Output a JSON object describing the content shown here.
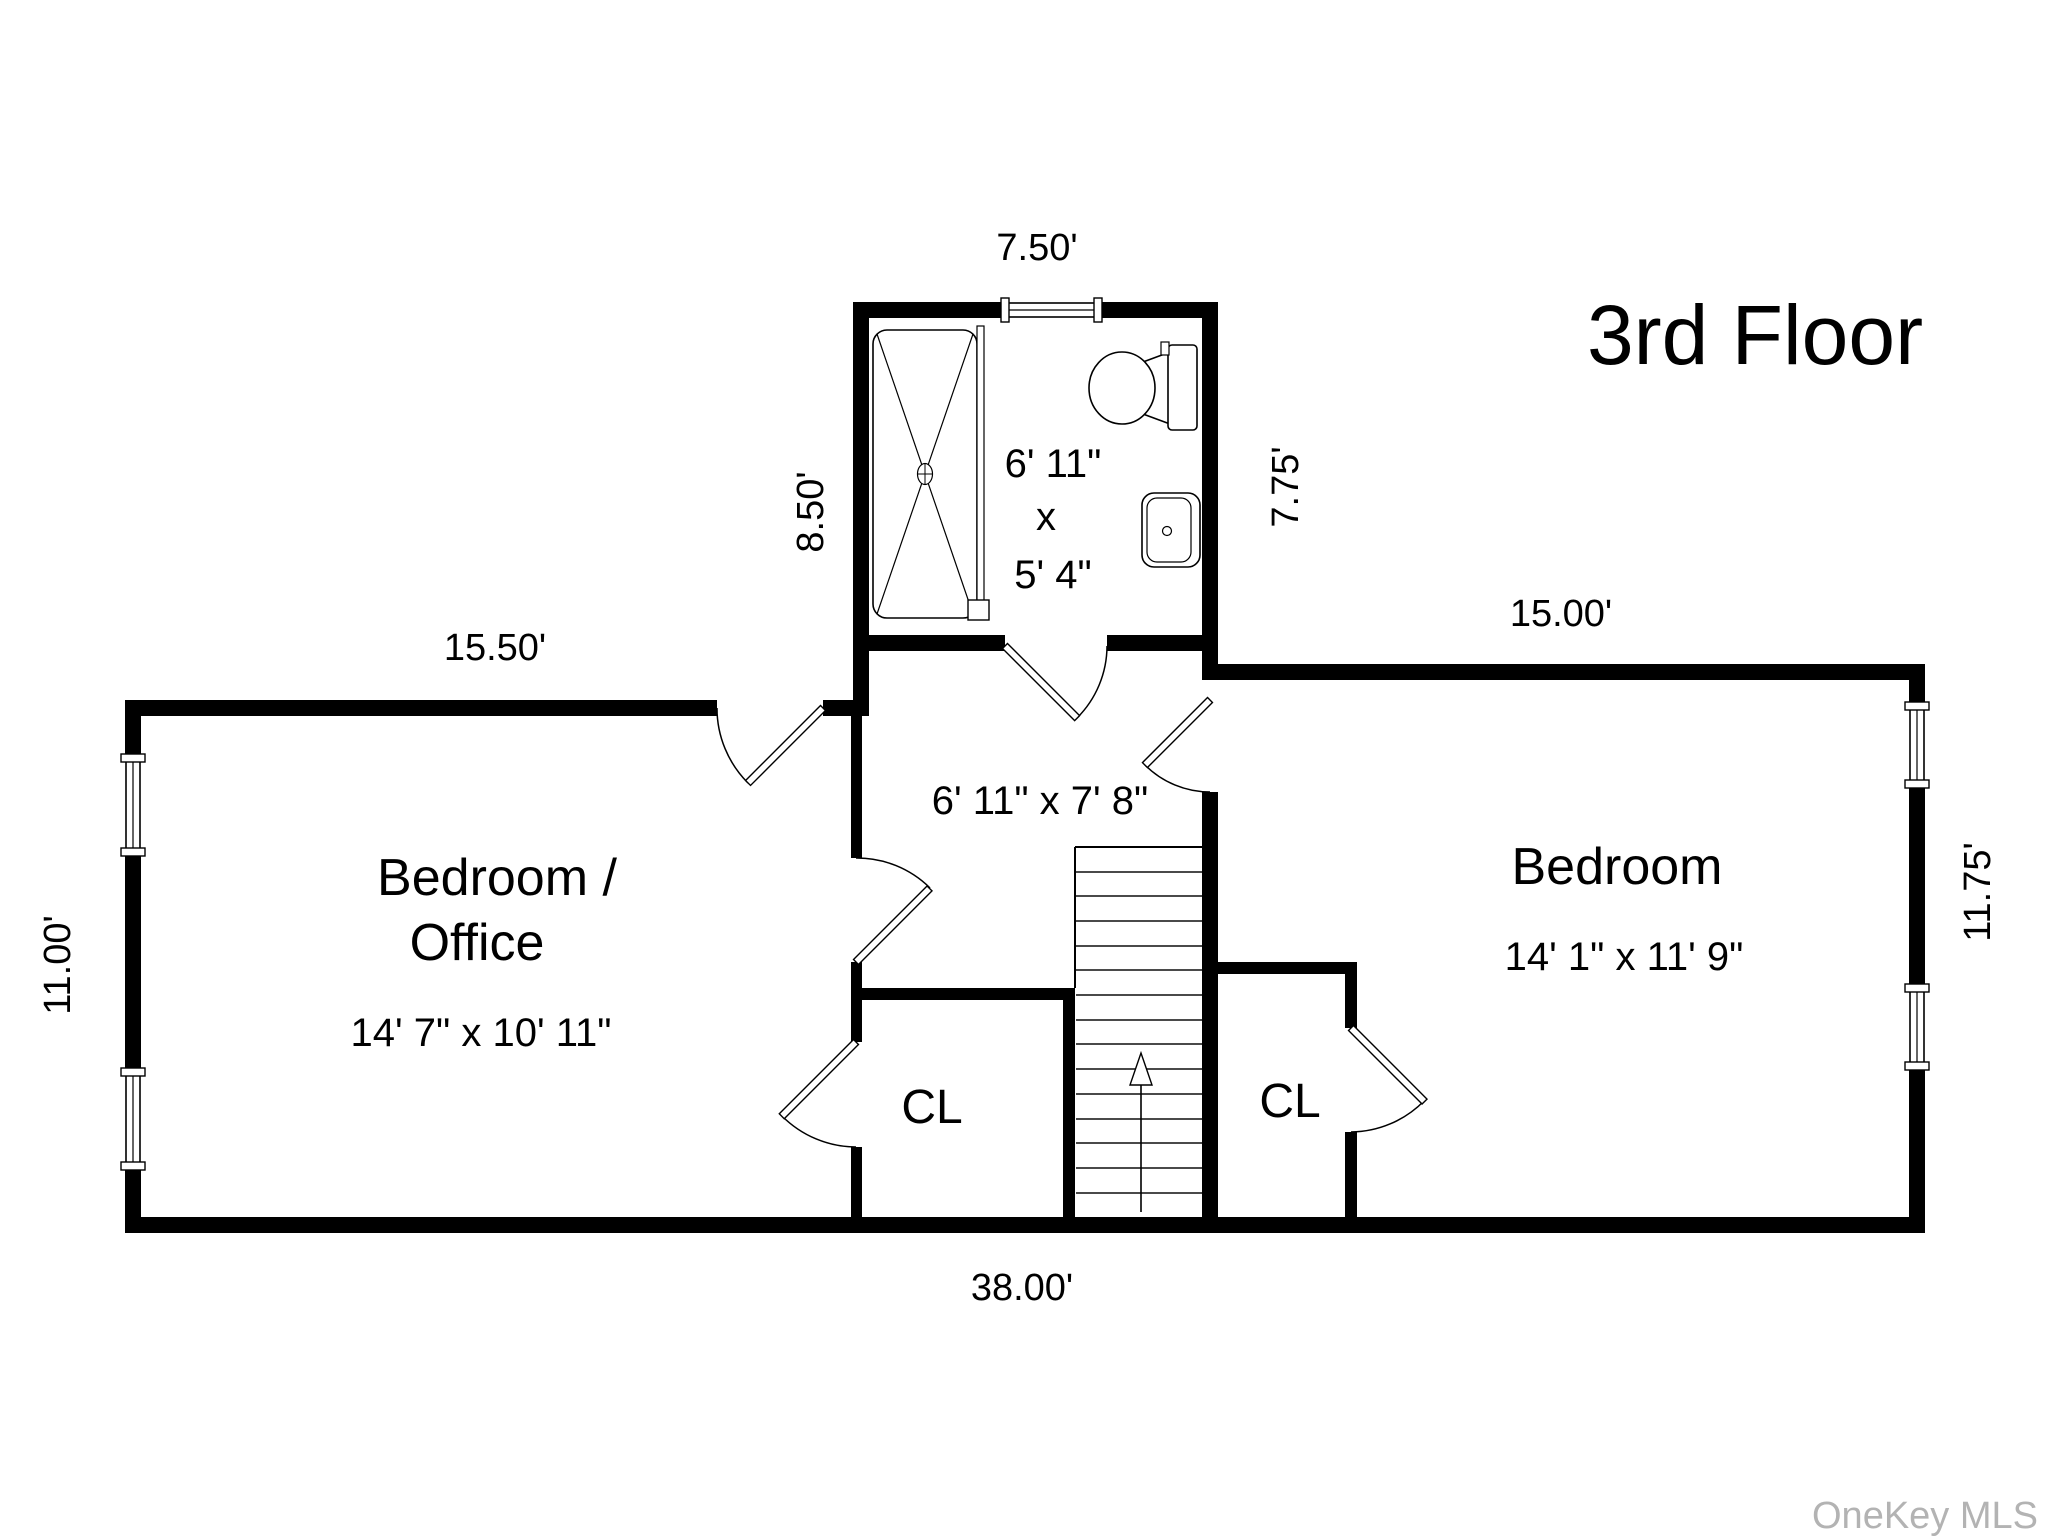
{
  "title": "3rd Floor",
  "watermark": "OneKey MLS",
  "rooms": {
    "bedroom_office": {
      "name_line1": "Bedroom /",
      "name_line2": "Office",
      "dimensions": "14' 7\" x 10' 11\""
    },
    "bedroom": {
      "name": "Bedroom",
      "dimensions": "14' 1\" x 11' 9\""
    },
    "bathroom": {
      "dim_width": "6' 11\"",
      "dim_sep": "x",
      "dim_depth": "5' 4\""
    },
    "hallway": {
      "dimensions": "6' 11\" x 7' 8\""
    },
    "closet_left": {
      "label": "CL"
    },
    "closet_right": {
      "label": "CL"
    }
  },
  "exterior_dimensions": {
    "bathroom_top": "7.50'",
    "bathroom_left": "8.50'",
    "bathroom_right": "7.75'",
    "left_wing_top": "15.50'",
    "right_wing_top": "15.00'",
    "left_side": "11.00'",
    "right_side": "11.75'",
    "bottom": "38.00'"
  },
  "colors": {
    "walls": "#000000",
    "background": "#ffffff",
    "watermark": "#b3b3b3"
  }
}
